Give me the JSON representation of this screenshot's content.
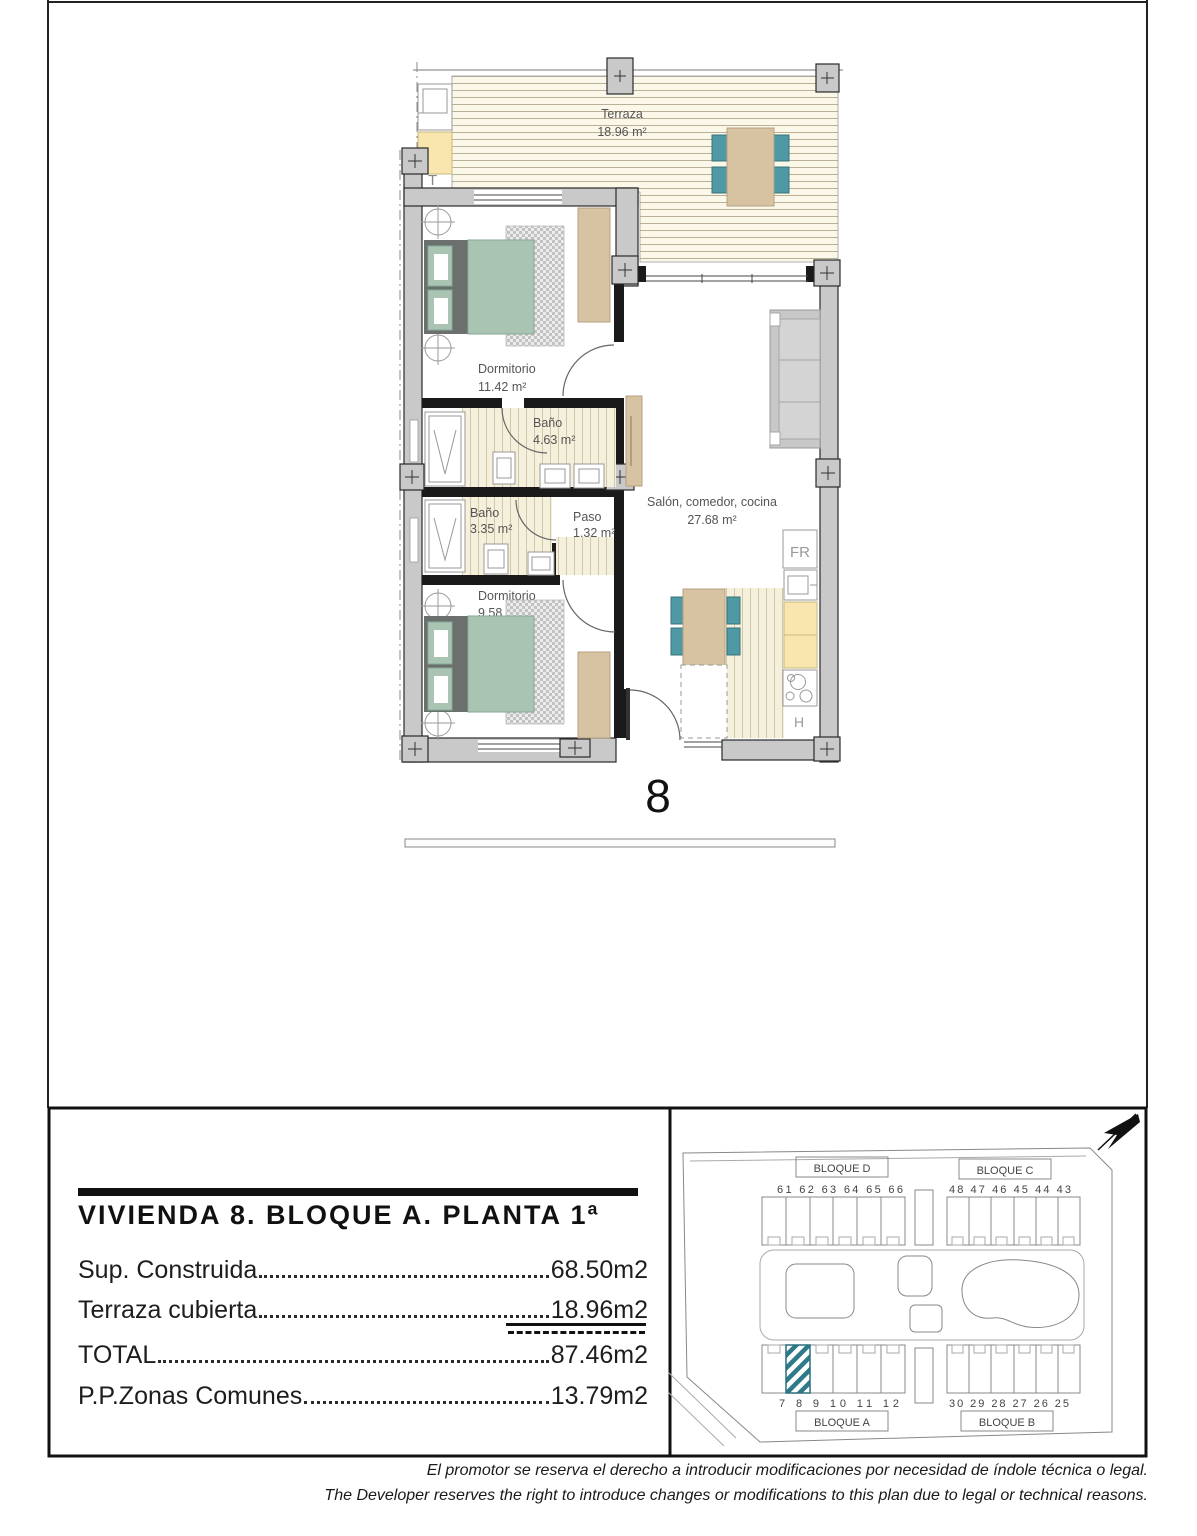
{
  "colors": {
    "wall_gray": "#c9c9c9",
    "wall_black": "#1a1a1a",
    "teal_chair": "#4e99a3",
    "teal_bed": "#a9c4b2",
    "tan_furniture": "#d7c3a2",
    "yellow_cabinet": "#f8e6ae",
    "deck_bg": "#fbf8ea",
    "deck_line": "#b9b195",
    "stripe_bg": "#f5f0db",
    "stripe_line": "#cfc8aa",
    "headboard_gray": "#6b6f6d",
    "sofa_gray": "#c8c8c8",
    "hatch_teal": "#2e7a8a",
    "label_gray": "#555555"
  },
  "plan": {
    "unit_number": "8",
    "rooms": [
      {
        "name": "Terraza",
        "area": "18.96 m²"
      },
      {
        "name": "Dormitorio",
        "area": "11.42 m²"
      },
      {
        "name": "Baño",
        "area": "4.63 m²"
      },
      {
        "name": "Baño",
        "area": "3.35 m²"
      },
      {
        "name": "Paso",
        "area": "1.32 m²"
      },
      {
        "name": "Dormitorio",
        "area": "9.58 m²"
      },
      {
        "name": "Salón, comedor, cocina",
        "area": "27.68 m²"
      }
    ],
    "fixtures": {
      "fridge": "FR",
      "oven": "H",
      "terrace_marker": "T"
    }
  },
  "spec": {
    "title": "VIVIENDA 8. BLOQUE A. PLANTA 1ª",
    "rows": [
      {
        "label": "Sup. Construida",
        "value": "68.50m2"
      },
      {
        "label": "Terraza cubierta",
        "value": "18.96m2"
      },
      {
        "label": "TOTAL",
        "value": "87.46m2"
      },
      {
        "label": "P.P.Zonas Comunes",
        "value": "13.79m2"
      }
    ]
  },
  "site": {
    "highlighted_unit": "8",
    "blocks": [
      {
        "name": "BLOQUE D",
        "units": [
          "61",
          "62",
          "63",
          "64",
          "65",
          "66"
        ]
      },
      {
        "name": "BLOQUE C",
        "units": [
          "48",
          "47",
          "46",
          "45",
          "44",
          "43"
        ]
      },
      {
        "name": "BLOQUE A",
        "units": [
          "7",
          "8",
          "9",
          "10",
          "11",
          "12"
        ]
      },
      {
        "name": "BLOQUE B",
        "units": [
          "30",
          "29",
          "28",
          "27",
          "26",
          "25"
        ]
      }
    ]
  },
  "footer": {
    "line1": "El promotor se reserva el derecho a introducir modificaciones por necesidad de índole técnica o legal.",
    "line2": "The Developer reserves the right to introduce changes or modifications to this plan due to legal or technical reasons."
  }
}
